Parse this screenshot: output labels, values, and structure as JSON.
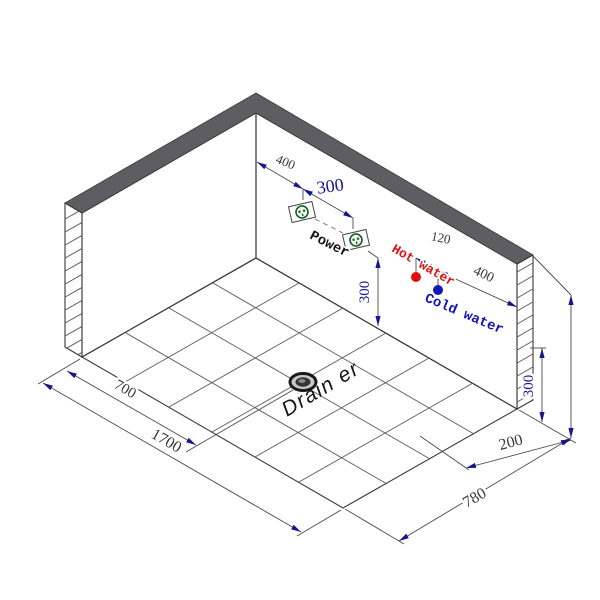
{
  "colors": {
    "hot": "#e01010",
    "cold": "#1414b8",
    "dim_navy": "#15158f",
    "dim_dark": "#38383c",
    "wall_top_band": "#5e5e62",
    "outlet_green": "#1b5e20",
    "line": "#4a4a4a"
  },
  "labels": {
    "power": "Power",
    "hot_water": "Hot water",
    "cold_water": "Cold water",
    "drain": "Drain er"
  },
  "dims": {
    "power_offset": "400",
    "power_spacing": "300",
    "power_height": "300",
    "water_spacing": "120",
    "water_offset": "400",
    "water_height": "300",
    "drain_offset_left": "700",
    "length_total": "1700",
    "corner_offset_right": "200",
    "depth_total": "780"
  }
}
